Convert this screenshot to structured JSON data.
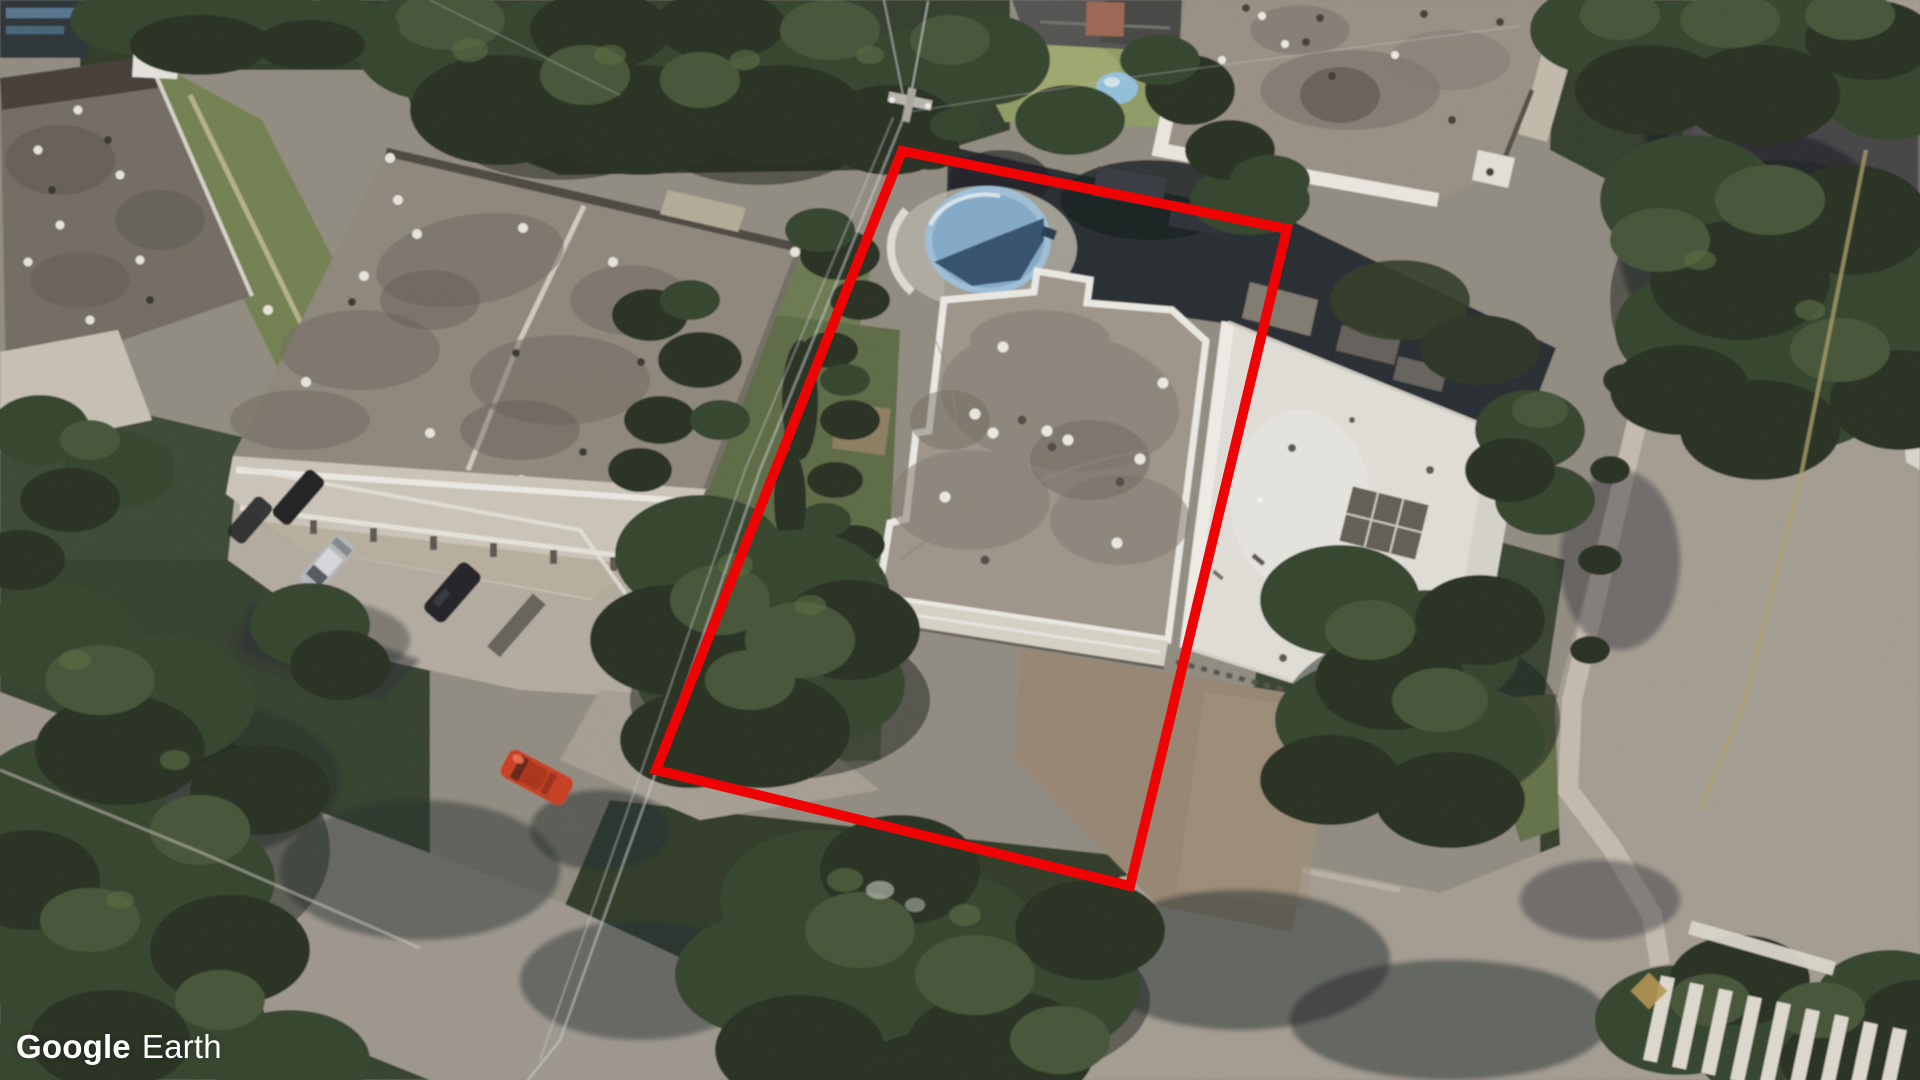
{
  "watermark": {
    "brand": "Google",
    "product": "Earth",
    "color": "#ffffff"
  },
  "view": {
    "provider": "Google Earth",
    "type": "aerial-oblique-satellite-imagery",
    "scene": "suburban residential block with flat-roof apartment buildings, trees, streets and a corner crosswalk",
    "image_width": 1920,
    "image_height": 1080
  },
  "annotation": {
    "name": "highlighted-property-boundary",
    "shape": "quadrilateral",
    "color": "#ee0404",
    "stroke_width": "10",
    "points": "902,151 1287,229 1130,886 656,770"
  },
  "features": {
    "highlighted_building": {
      "roof_color": "#9b9286",
      "parapet_color": "#efede6",
      "description": "flat-roof building inside the red boundary"
    },
    "pool": {
      "type": "round above-ground pool",
      "rim_color": "#9dc0da",
      "water_light_color": "#7fa9c9",
      "water_dark_color": "#2a4a66",
      "center_x": 988,
      "center_y": 240
    },
    "white_building": {
      "roof_color": "#e2e0d8"
    },
    "top_left_building": {
      "roof_color": "#8b8377"
    },
    "top_right_building": {
      "roof_color": "#968d80"
    },
    "far_left_building": {
      "roof_color": "#6e665c"
    },
    "vehicles": [
      {
        "name": "red-car",
        "color": "#c93418",
        "location": "street, lower left"
      },
      {
        "name": "silver-car",
        "color": "#b4b7ba",
        "location": "parking lot"
      },
      {
        "name": "black-car",
        "color": "#17191c",
        "location": "parking lot"
      },
      {
        "name": "dark-car",
        "color": "#121417",
        "location": "parking lot upper row"
      },
      {
        "name": "blue-car",
        "color": "#4d7fb3",
        "location": "lower left image edge"
      }
    ],
    "road_markings": {
      "crosswalk_stripes": 9,
      "stripe_color": "#e0dbce",
      "stop_bar": true,
      "tactile_pad_color": "#b29448",
      "center_line_color": "#ae9f63"
    }
  },
  "palette": {
    "road": "#9b948a",
    "parking_pavement": "#b2aa9e",
    "sidewalk": "#c6beae",
    "tree_dark": "#1b2517",
    "tree_mid": "#2c3a23",
    "grass": "#6d7c49",
    "shadow": "#14191f",
    "patio": "#93826d"
  }
}
